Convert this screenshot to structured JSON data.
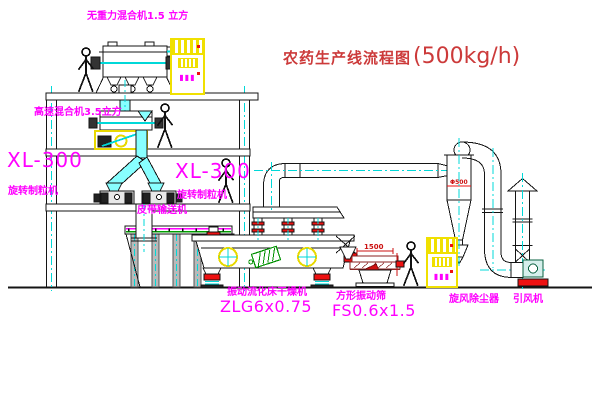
{
  "title": {
    "text": "农药生产线流程图",
    "capacity": "(500kg/h)"
  },
  "labels": {
    "top_mixer": "无重力混合机1.5 立方",
    "highspeed_mixer": "高速混合机3.5立方",
    "granulator_model_left": "XL-300",
    "granulator_name_left": "旋转制粒机",
    "granulator_model_right": "XL-300",
    "granulator_name_right": "旋转制粒机",
    "belt_conveyor": "皮带输送机",
    "dryer_name": "振动流化床干燥机",
    "dryer_model": "ZLG6x0.75",
    "sieve_name": "方形振动筛",
    "sieve_model": "FS0.6x1.5",
    "cyclone_name": "旋风除尘器",
    "fan_name": "引风机"
  },
  "dimensions": {
    "sieve_width": "1500",
    "cyclone_dia": "Φ500"
  },
  "cabinets": {
    "display": "▮▮▮"
  },
  "colors": {
    "label_magenta": "#ff00ff",
    "title_red": "#cc3a3a",
    "line_black": "#141414",
    "centerline_cyan": "#00d8d8",
    "chute_cyan": "#88ffff",
    "cabinet_yellow": "#f0e000",
    "accent_red": "#ee1111",
    "motor_green": "#009000",
    "sieve_darkred": "#8a2222"
  }
}
